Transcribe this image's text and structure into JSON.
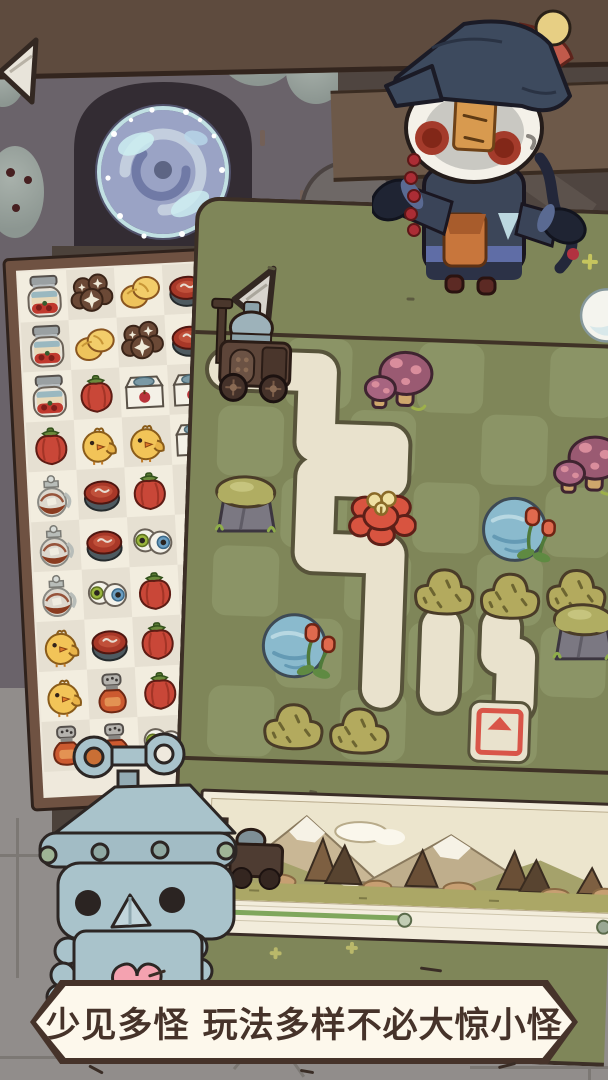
{
  "caption": {
    "text": "少见多怪 玩法多样不必大惊小怪"
  },
  "banner": {
    "progress_percent": 48
  },
  "match3": {
    "grid": [
      [
        "jar",
        "mushrooms",
        "buns",
        "meat"
      ],
      [
        "jar",
        "buns",
        "mushrooms",
        "meat"
      ],
      [
        "jar",
        "pepper",
        "tofu",
        "tofu"
      ],
      [
        "pepper",
        "chick",
        "chick",
        "tofu"
      ],
      [
        "jug",
        "meat",
        "pepper",
        null
      ],
      [
        "jug",
        "meat",
        "eyes",
        null
      ],
      [
        "jug",
        "eyes",
        "pepper",
        null
      ],
      [
        "chick",
        "meat",
        "pepper",
        null
      ],
      [
        "chick",
        "shaker",
        "pepper",
        null
      ],
      [
        "shaker",
        "shaker",
        "eyes",
        null
      ]
    ]
  },
  "board": {
    "props": [
      {
        "type": "sign",
        "x": 30,
        "y": 60,
        "w": 52,
        "h": 82
      },
      {
        "type": "tractor",
        "x": 14,
        "y": 90,
        "w": 94,
        "h": 114
      },
      {
        "type": "mushrooms",
        "x": 170,
        "y": 136,
        "w": 70,
        "h": 72
      },
      {
        "type": "mushrooms",
        "x": 362,
        "y": 214,
        "w": 70,
        "h": 74
      },
      {
        "type": "rock",
        "x": 22,
        "y": 268,
        "w": 70,
        "h": 70
      },
      {
        "type": "flower",
        "x": 158,
        "y": 276,
        "w": 70,
        "h": 68
      },
      {
        "type": "pond",
        "x": 290,
        "y": 280,
        "w": 80,
        "h": 70
      },
      {
        "type": "bush",
        "x": 224,
        "y": 350,
        "w": 66,
        "h": 54
      },
      {
        "type": "bush",
        "x": 290,
        "y": 352,
        "w": 64,
        "h": 54
      },
      {
        "type": "bush",
        "x": 356,
        "y": 346,
        "w": 66,
        "h": 58
      },
      {
        "type": "rock",
        "x": 364,
        "y": 384,
        "w": 68,
        "h": 64
      },
      {
        "type": "pond",
        "x": 74,
        "y": 404,
        "w": 82,
        "h": 70
      },
      {
        "type": "bush",
        "x": 78,
        "y": 490,
        "w": 68,
        "h": 54
      },
      {
        "type": "bush",
        "x": 144,
        "y": 492,
        "w": 68,
        "h": 54
      },
      {
        "type": "target",
        "x": 286,
        "y": 488,
        "w": 64,
        "h": 66
      },
      {
        "type": "orb",
        "x": 382,
        "y": 72,
        "w": 58,
        "h": 58
      },
      {
        "type": "sparkle",
        "x": 384,
        "y": 40,
        "w": 16,
        "h": 16
      }
    ]
  },
  "colors": {
    "path": "#e9e2cd",
    "board": "#7f8659",
    "target_red": "#d95548",
    "caption_ink": "#46332a",
    "progress_green": "#7fa75c"
  }
}
